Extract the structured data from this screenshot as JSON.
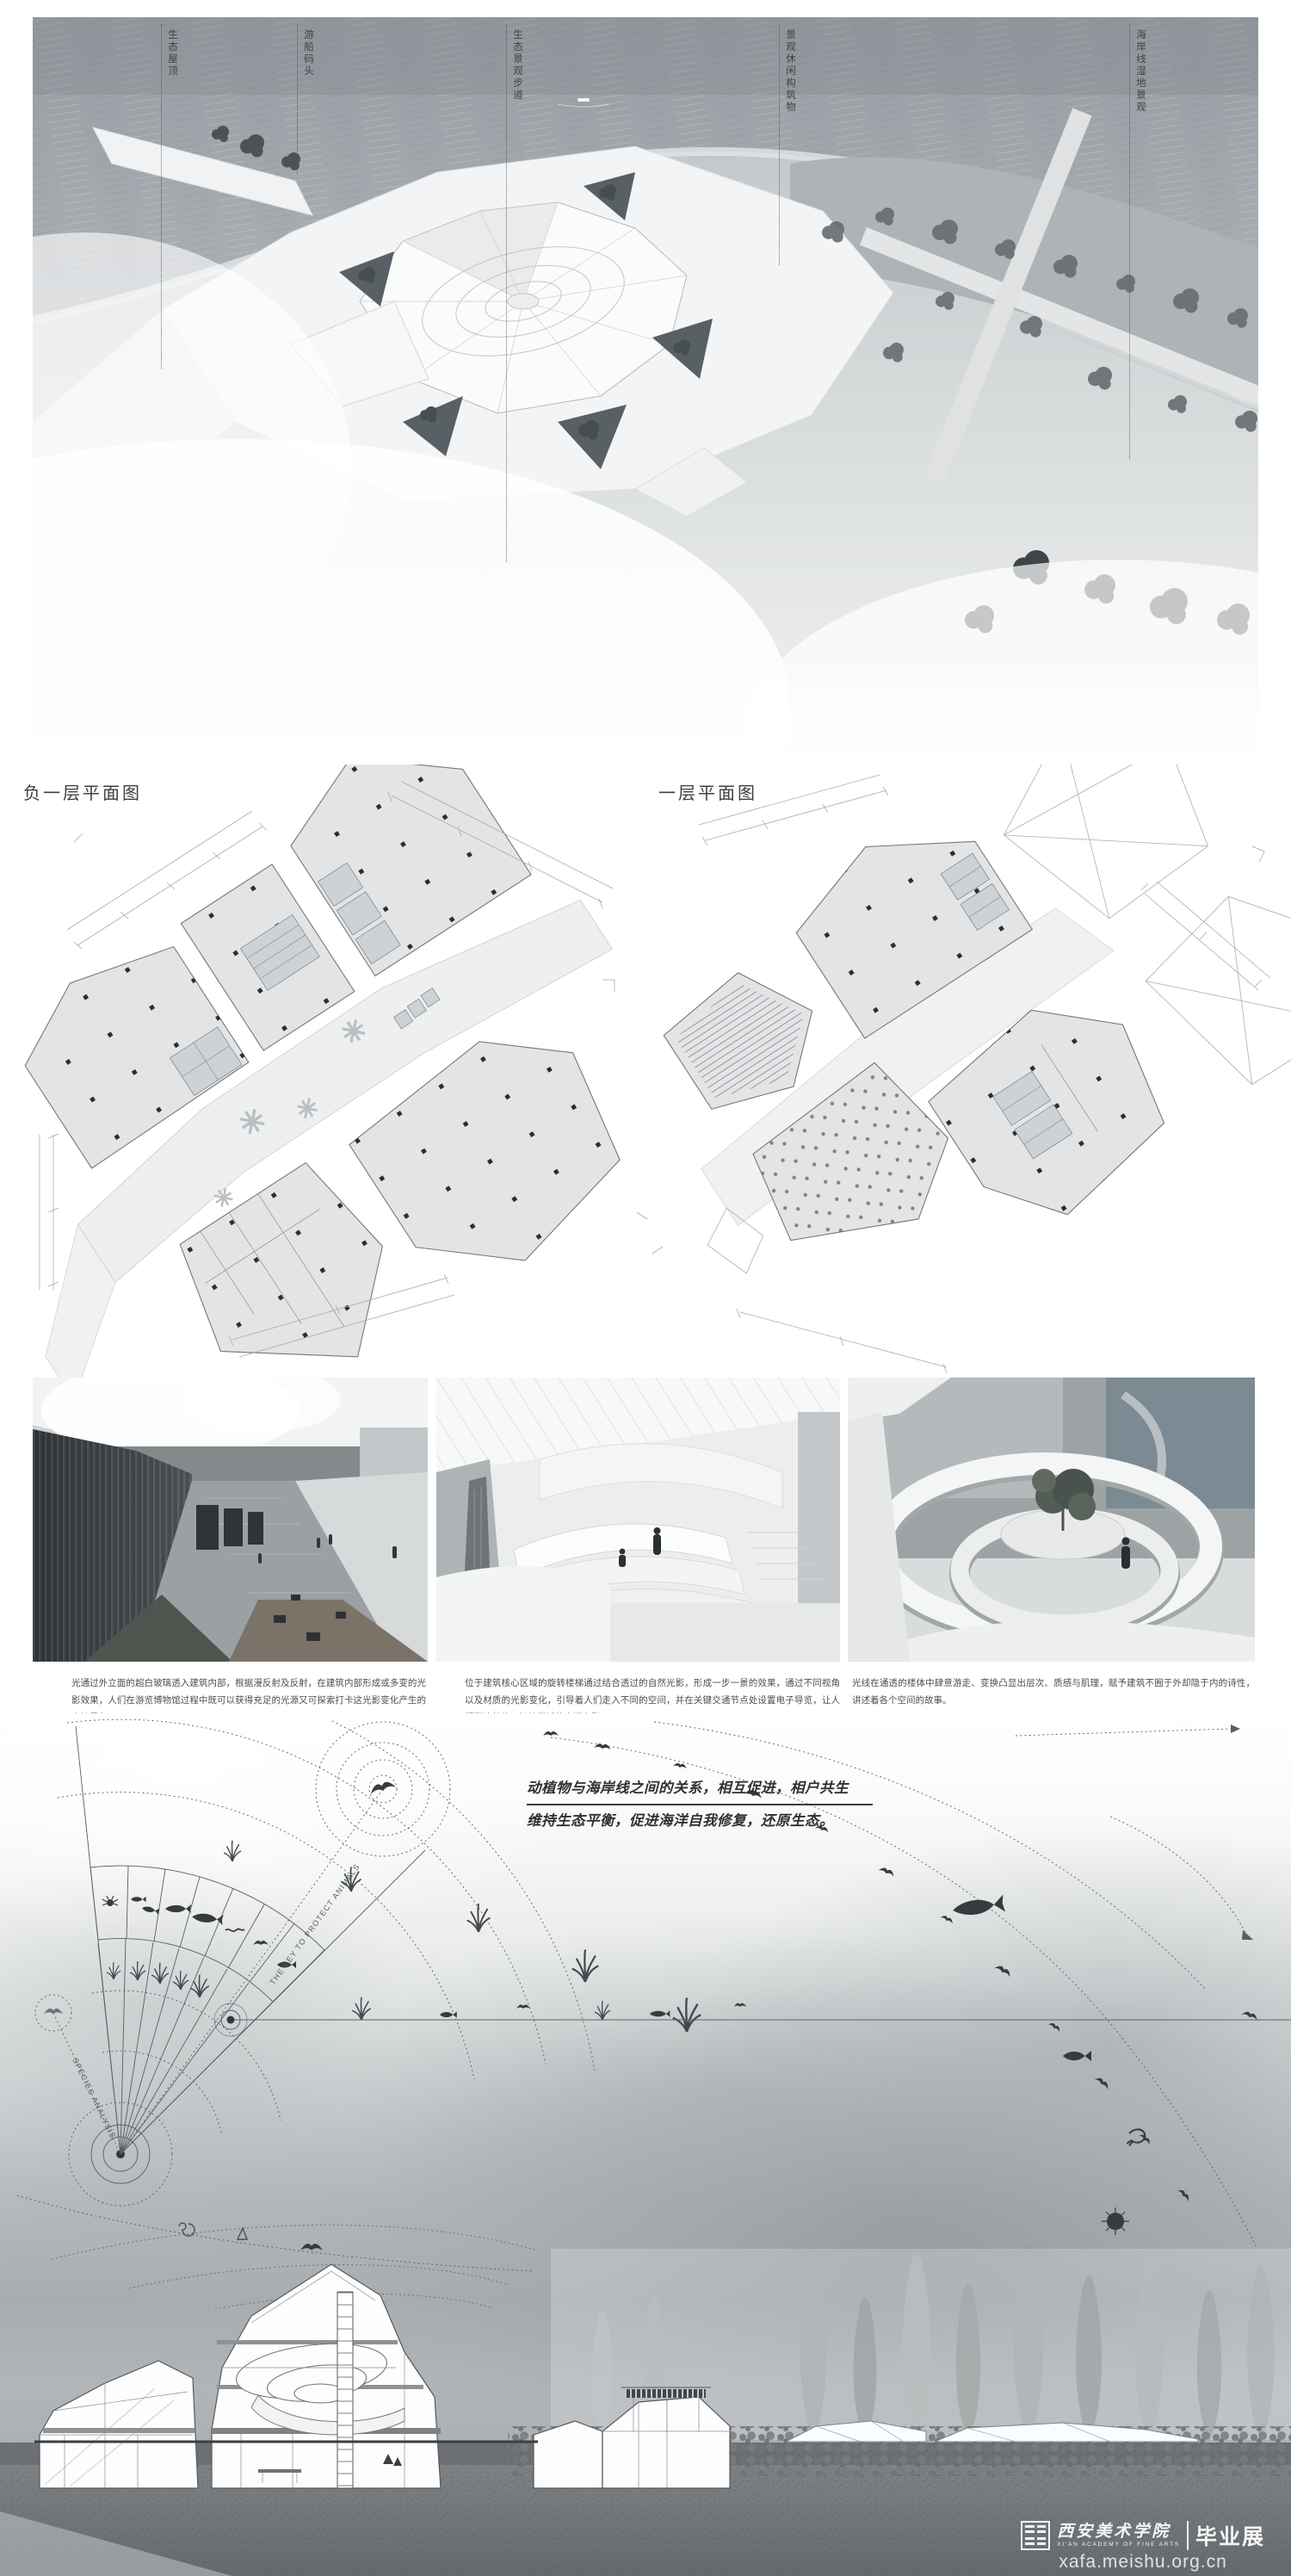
{
  "aerial": {
    "labels": [
      {
        "text": "生态屋顶"
      },
      {
        "text": "游船码头"
      },
      {
        "text": "生态景观步道"
      },
      {
        "text": "景观休闲构筑物"
      },
      {
        "text": "海岸线湿地景观"
      }
    ]
  },
  "plans": {
    "left_title": "负一层平面图",
    "right_title": "一层平面图"
  },
  "renders": {
    "captions": [
      {
        "text": "光通过外立面的超白玻璃透入建筑内部，根据漫反射及反射，在建筑内部形成或多变的光影效果，人们在游览博物馆过程中既可以获得充足的光源又可探索打卡这光影变化产生的奇妙景象。"
      },
      {
        "text": "位于建筑核心区域的旋转楼梯通过结合透过的自然光影，形成一步一景的效果，通过不同视角以及材质的光影变化，引导着人们走入不同的空间，并在关键交通节点处设置电子导览，让人们更清楚的了解该区域的空间主题。"
      },
      {
        "text": "光线在通透的楼体中肆意游走、变换凸显出层次、质感与肌理，赋予建筑不囿于外却隐于内的诗性，讲述着各个空间的故事。"
      }
    ]
  },
  "ecology": {
    "headline_line1": "动植物与海岸线之间的关系，相互促进，相户共生",
    "headline_line2": "维持生态平衡，促进海洋自我修复，还原生态。",
    "key_label": "THE KEY TO PROTECT ANIMALS",
    "species_label": "SPECIES ANALYSIS"
  },
  "watermark": {
    "school_cn": "西安美术学院",
    "school_en": "XI'AN ACADEMY OF FINE ARTS",
    "exhibition": "毕业展",
    "website": "xafa.meishu.org.cn"
  },
  "colors": {
    "sea": "#a0a6ac",
    "plaza": "#f3f4f5",
    "ink": "#3a3e41",
    "ground": "#7b7f82"
  }
}
